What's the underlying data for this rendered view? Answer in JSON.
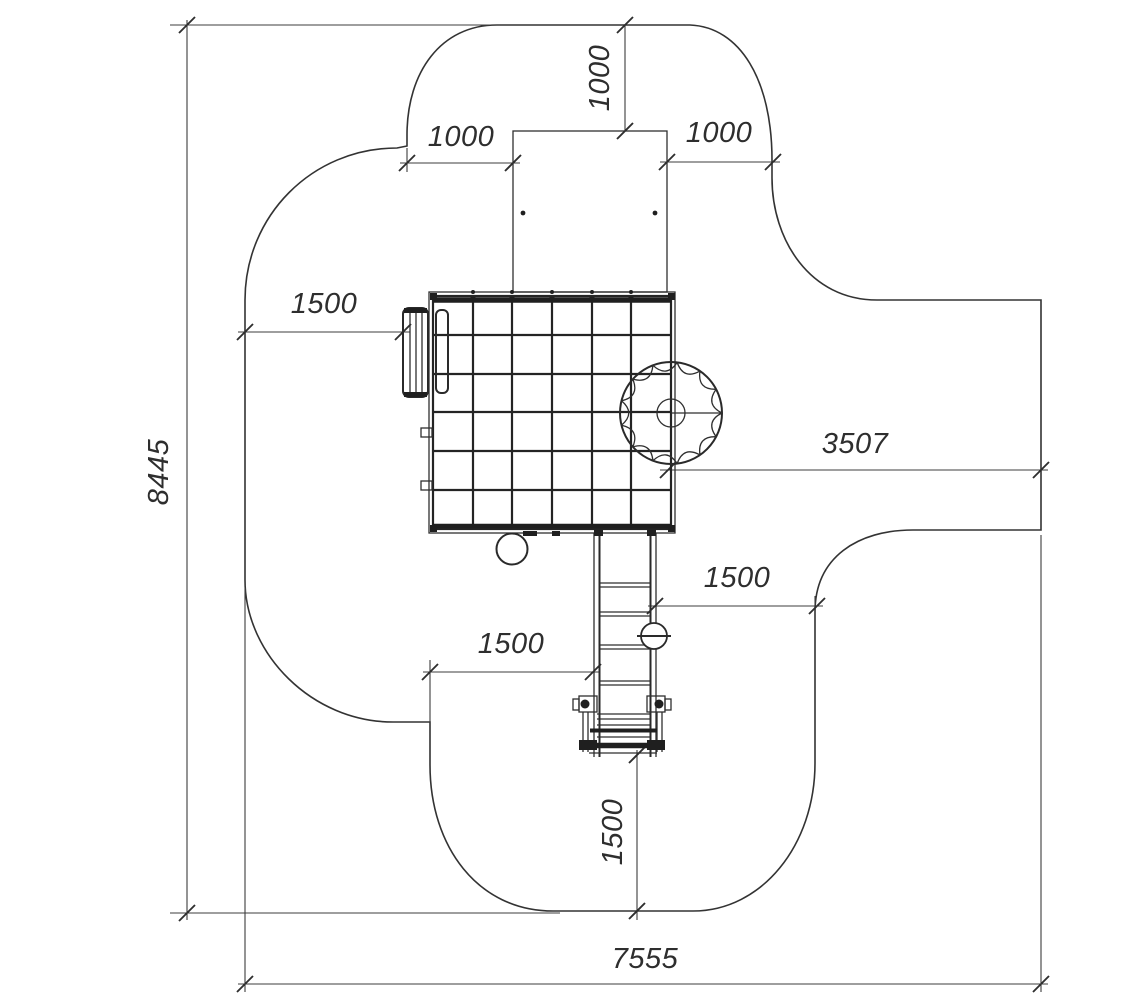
{
  "drawing": {
    "type": "playground-equipment-plan-view",
    "background": "#ffffff",
    "line_color": "#2e2e2e",
    "units": "mm"
  },
  "dimensions": {
    "overall_height": "8445",
    "overall_width": "7555",
    "top_zone_depth": "1000",
    "top_zone_left": "1000",
    "top_zone_right": "1000",
    "left_zone_width": "1500",
    "slide_exit_zone": "3507",
    "ladder_zone_right": "1500",
    "ladder_zone_left": "1500",
    "bottom_zone_depth": "1500"
  }
}
